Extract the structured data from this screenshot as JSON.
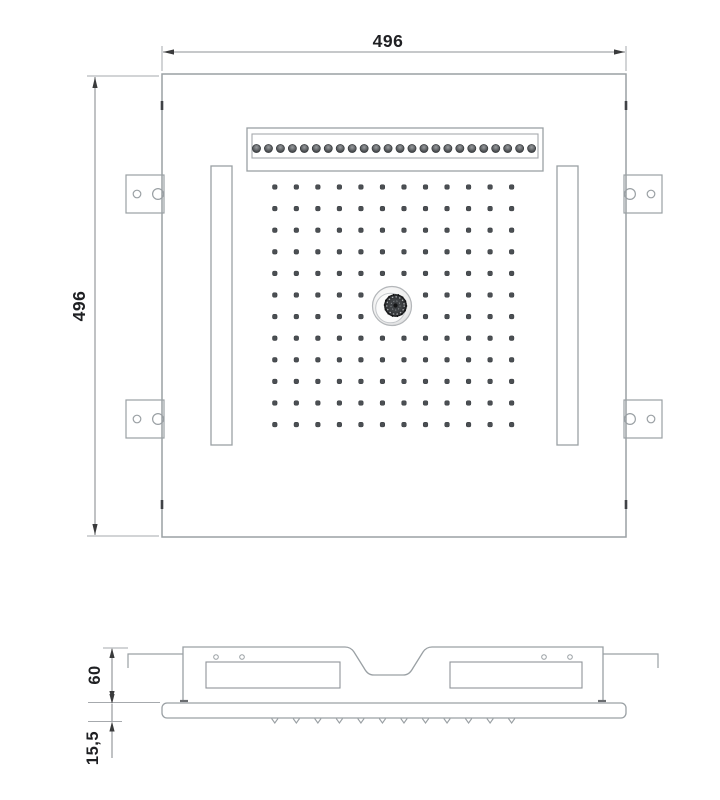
{
  "colors": {
    "line": "#9aa0a4",
    "line_light": "#a6a9ad",
    "dim_line": "#8d9094",
    "arrow": "#3a3b3c",
    "text": "#1f2023",
    "dot_fill": "#4b4f53",
    "dot_stroke": "#303438",
    "tick_dark": "#3f4246",
    "knob_dark": "#333538",
    "background": "#ffffff"
  },
  "top_view": {
    "width_label": "496",
    "height_label": "496",
    "waterfall_nozzle_count": 24,
    "spray_grid": {
      "cols": 12,
      "rows": 12,
      "hidden_by_center_knob": 4
    },
    "mounting_tab_count": 4,
    "led_strip_count": 2,
    "center_knob": true
  },
  "side_view": {
    "height_label": "60",
    "plate_thickness_label": "15,5",
    "nozzle_tick_count": 12
  }
}
